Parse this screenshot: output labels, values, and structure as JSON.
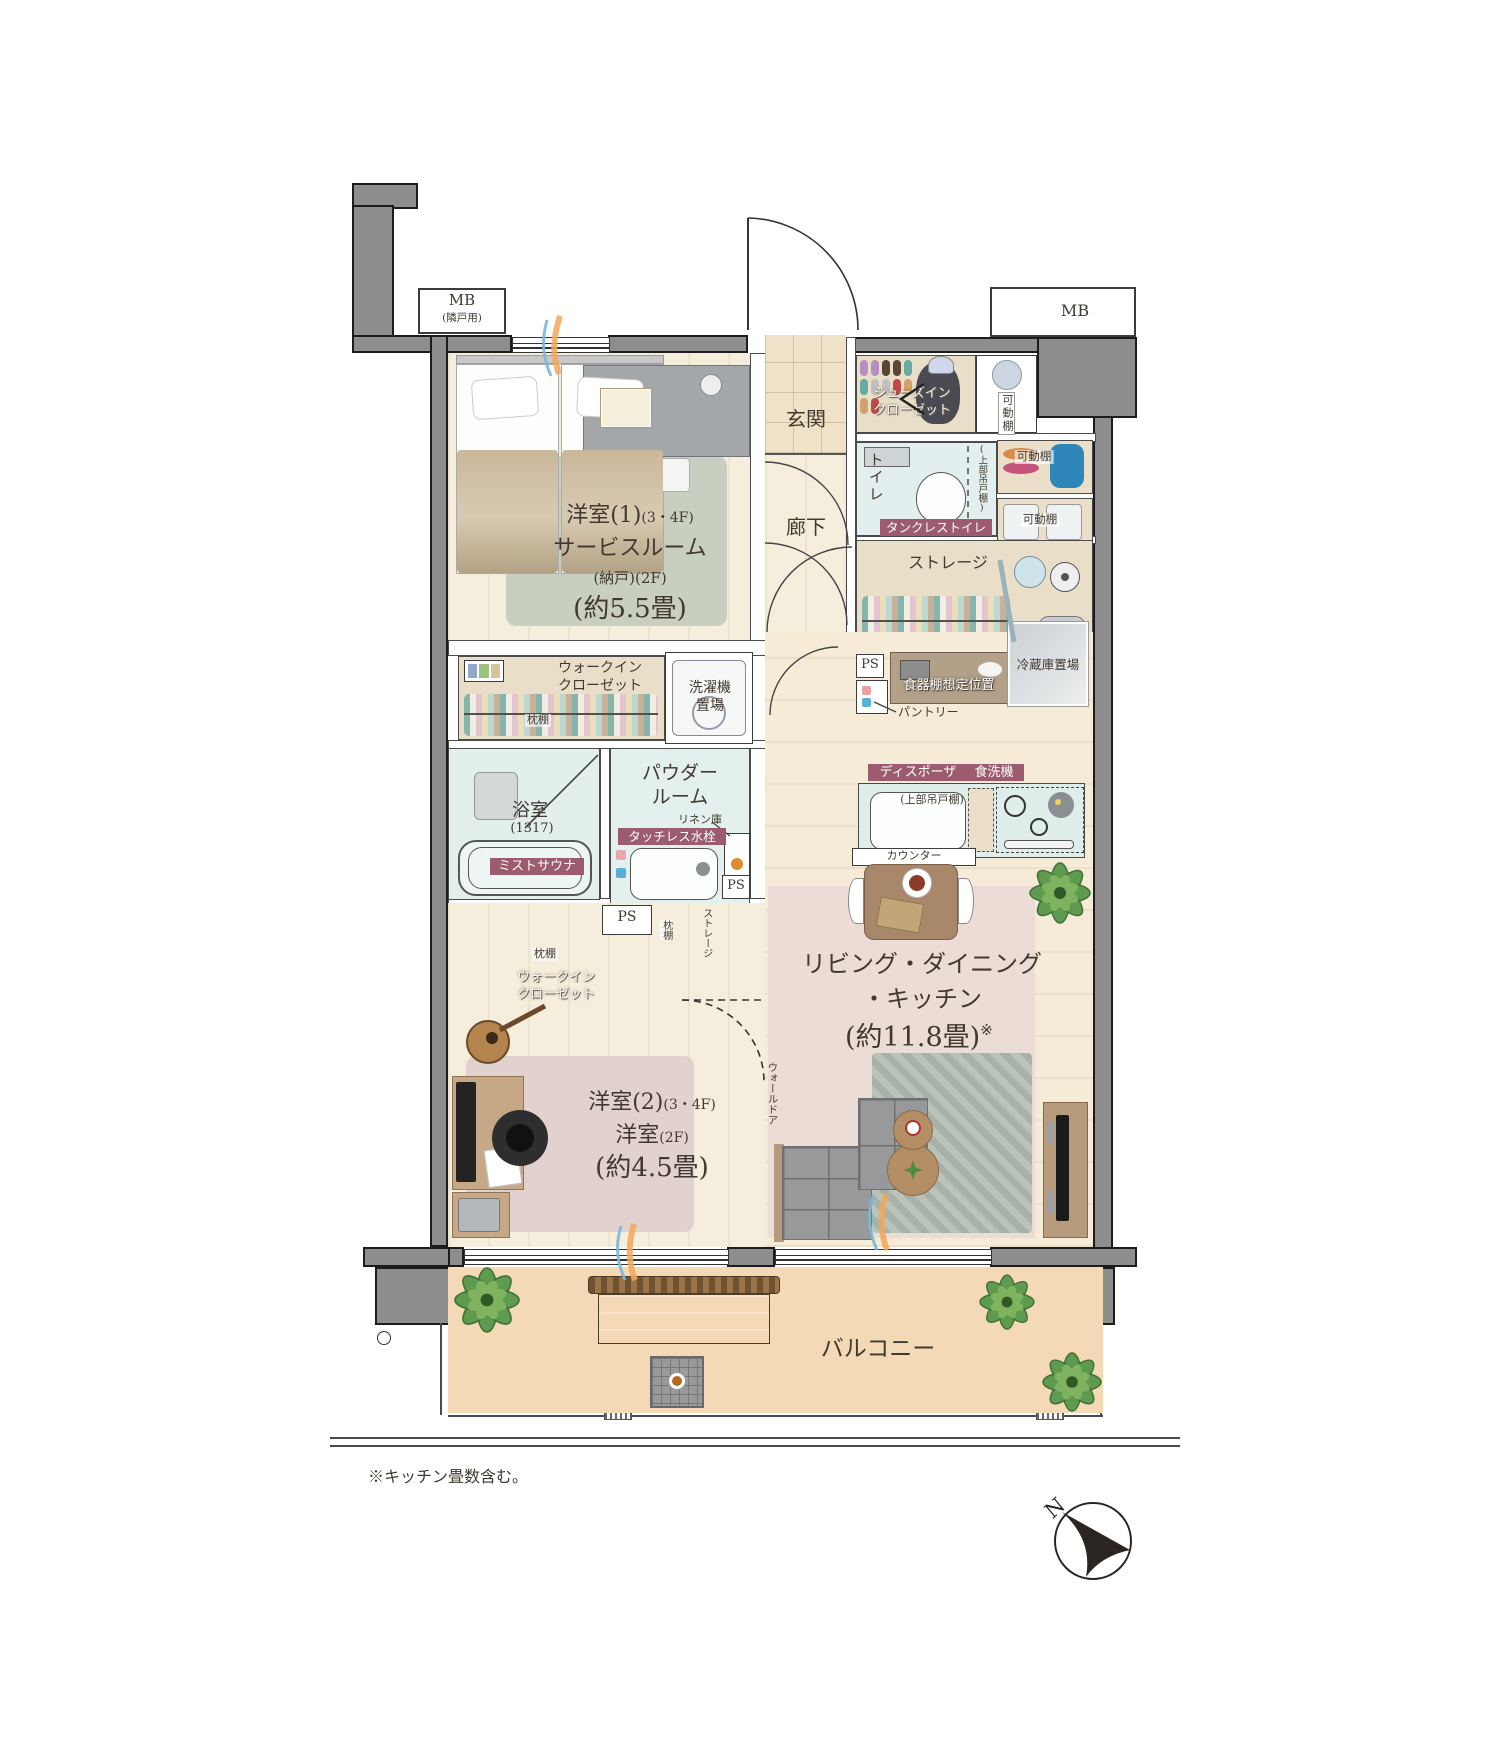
{
  "mb": {
    "left_title": "MB",
    "left_sub": "(隣戸用)",
    "right_title": "MB"
  },
  "rooms": {
    "genkan": "玄関",
    "corridor": "廊下",
    "toilet": "トイレ",
    "bedroom1": {
      "l1": "洋室(1)",
      "l1s": "(3・4F)",
      "l2": "サービスルーム",
      "l3": "(納戸)",
      "l3s": "(2F)",
      "size": "(約5.5畳)"
    },
    "bedroom2": {
      "l1": "洋室(2)",
      "l1s": "(3・4F)",
      "l2": "洋室",
      "l2s": "(2F)",
      "size": "(約4.5畳)"
    },
    "ldk": {
      "l1": "リビング・ダイニング",
      "l2": "・キッチン",
      "size": "(約11.8畳)",
      "size_note": "※"
    },
    "powder": {
      "l1": "パウダー",
      "l2": "ルーム"
    },
    "bath": {
      "name": "浴室",
      "size": "(1317)"
    },
    "balcony": "バルコニー"
  },
  "storage": {
    "sic_l1": "シューズイン",
    "sic_l2": "クローゼット",
    "kadodana": "可動棚",
    "storage": "ストレージ",
    "wic_l1": "ウォークイン",
    "wic_l2": "クローゼット",
    "makuradana": "枕棚",
    "laundry_l1": "洗濯機",
    "laundry_l2": "置場",
    "linen": "リネン庫",
    "pantry": "パントリー",
    "upper_cabinet": "(上部吊戸棚)",
    "walldoor": "ウォールドア",
    "ps": "PS"
  },
  "kitchen": {
    "cupboard": "食器棚想定位置",
    "fridge": "冷蔵庫置場",
    "counter": "カウンター"
  },
  "badges": {
    "tankless": "タンクレストイレ",
    "touchless": "タッチレス水栓",
    "mist": "ミストサウナ",
    "disposer": "ディスポーザ",
    "dishwasher": "食洗機"
  },
  "note": "※キッチン畳数含む。",
  "compass_n": "N",
  "colors": {
    "badge": "#9c5b6e",
    "wall": "#8d8d8d",
    "balcony": "#f3d9b5"
  }
}
